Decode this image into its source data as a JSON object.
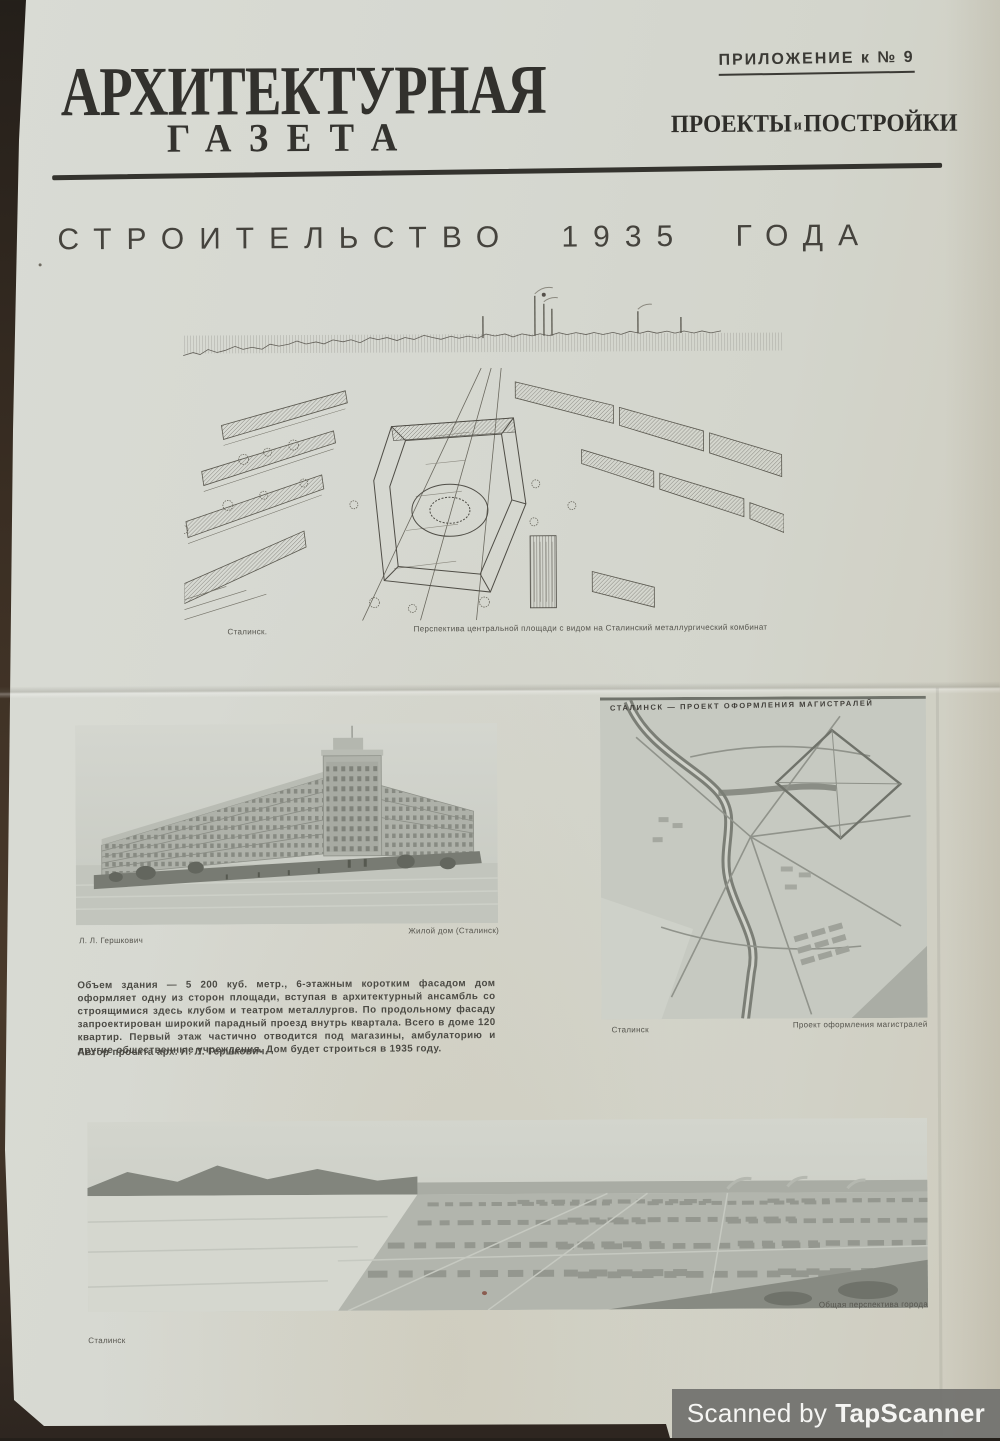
{
  "masthead": {
    "title": "АРХИТЕКТУРНАЯ",
    "subtitle": "ГАЗЕТА",
    "supplement": "ПРИЛОЖЕНИЕ к № 9",
    "section": {
      "projects": "ПРОЕКТЫ",
      "conj": "и",
      "buildings": "ПОСТРОЙКИ"
    }
  },
  "headline": "СТРОИТЕЛЬСТВО 1935 ГОДА",
  "figures": {
    "aerial": {
      "caption_left": "Сталинск.",
      "caption_right": "Перспектива центральной площади с видом на Сталинский металлургический комбинат"
    },
    "building": {
      "caption_left": "Л. Л. Гершкович",
      "caption_right": "Жилой дом (Сталинск)"
    },
    "map": {
      "overlay_title": "СТАЛИНСК — ПРОЕКТ ОФОРМЛЕНИЯ МАГИСТРАЛЕЙ",
      "caption_left": "Сталинск",
      "caption_right": "Проект оформления магистралей"
    },
    "panorama": {
      "caption_left": "Сталинск",
      "caption_right": "Общая перспектива города"
    }
  },
  "article": {
    "body": "Объем здания — 5 200 куб. метр., 6-этажным коротким фасадом дом оформляет одну из сторон площади, вступая в архитектурный ансамбль со строящимися здесь клубом и театром металлургов. По продольному фасаду запроектирован широкий парадный проезд внутрь квартала. Всего в доме 120 квартир. Первый этаж частично отводится под магазины, амбулаторию и другие общественные учреждения. Дом будет строиться в 1935 году.",
    "author": "Автор проекта арх. Л. Л. Гершкович."
  },
  "watermark": {
    "prefix": "Scanned by",
    "brand": "TapScanner"
  },
  "colors": {
    "paper": "#d6d8d1",
    "ink": "#32312d",
    "background": "#3a2e23",
    "watermark_bar": "#717170"
  }
}
